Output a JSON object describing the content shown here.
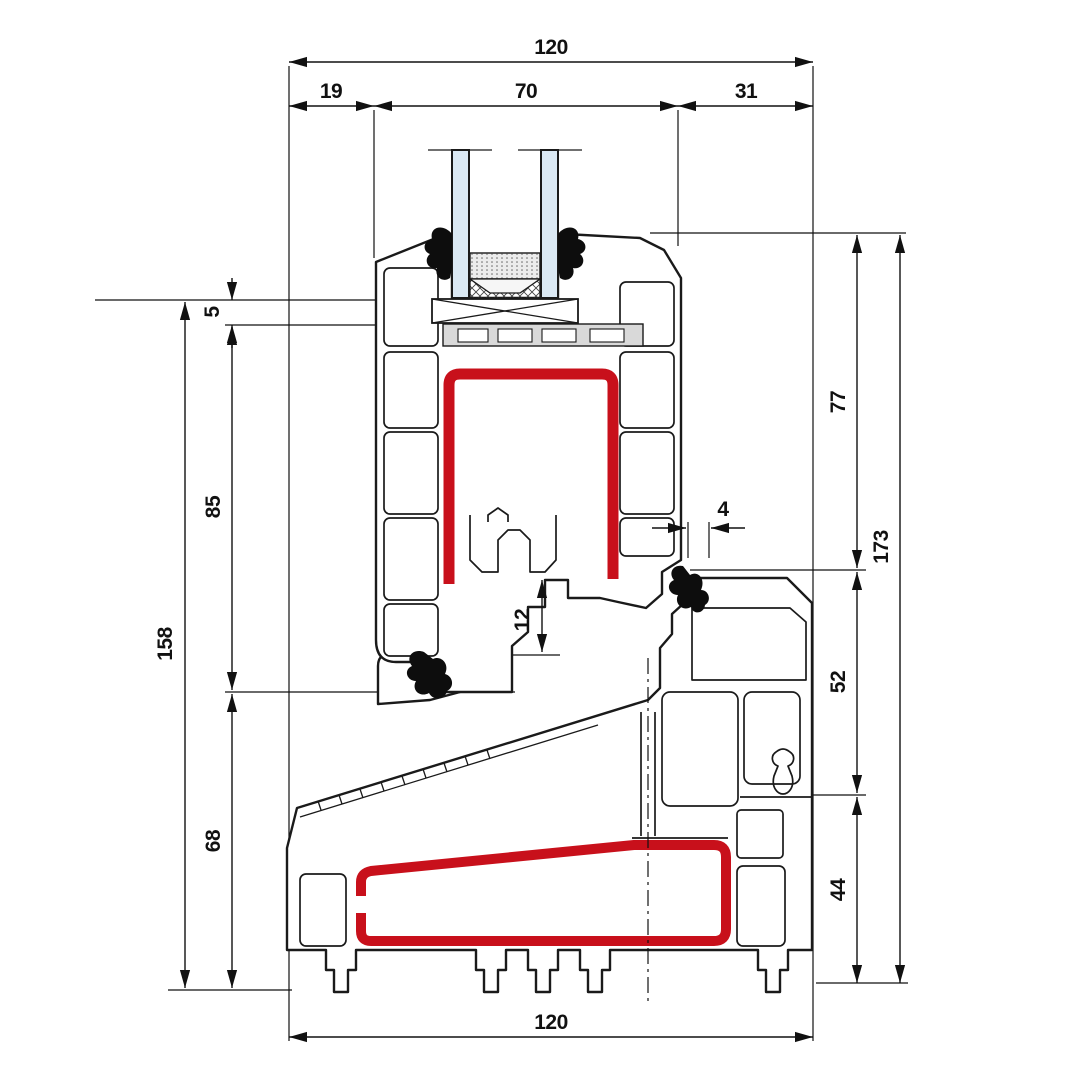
{
  "drawing": {
    "kind": "window-profile-cross-section",
    "colors": {
      "line": "#1a1a1a",
      "dimension": "#111111",
      "reinforcement": "#c8101b",
      "glass": "#dbe9f4",
      "gasket": "#0d0d0d",
      "infill_gray": "#d9d9d9"
    },
    "dimensions": {
      "top_total": "120",
      "top_left": "19",
      "top_center": "70",
      "top_right": "31",
      "glass_seat": "5",
      "sash_height": "85",
      "left_total": "158",
      "sill_left": "68",
      "sash_right": "77",
      "right_total": "173",
      "frame_mid": "52",
      "sill_right": "44",
      "gasket_width": "4",
      "overlap": "12",
      "bottom_total": "120"
    }
  }
}
